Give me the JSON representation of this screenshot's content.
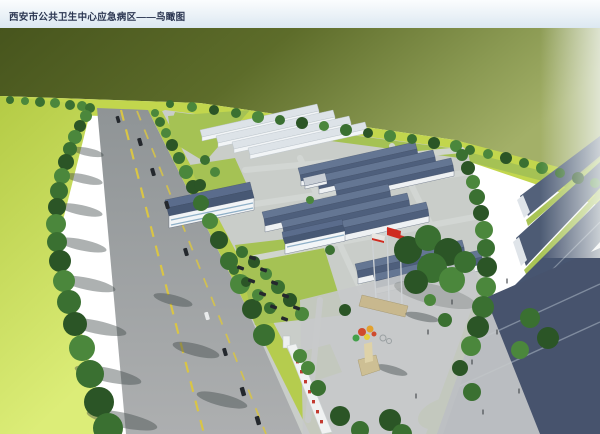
{
  "header": {
    "title": "西安市公共卫生中心应急病区——鸟瞰图"
  },
  "colors": {
    "title_text": "#2a3550",
    "titlebar_top": "#fbfdfe",
    "titlebar_bottom": "#dce8f1",
    "field_dark": "#47551d",
    "field_light": "#a3b068",
    "grass_bright": "#c2d64d",
    "grass_pale": "#dced78",
    "tree_dark": "#2b5526",
    "tree_light": "#5d9a49",
    "road_surface": "#9a9ea0",
    "road_marking": "#d9c545",
    "campus_paving": "#c9cdc9",
    "lawn_green": "#a5c254",
    "roof_slate_light": "#647693",
    "roof_slate_dark": "#4e5f7c",
    "roof_white_building": "#dde3e8",
    "wall_white": "#f2f5f7",
    "warehouse_roof": "#47536d",
    "flag_red": "#cf2b20",
    "flag_base_tan": "#c8b88e",
    "gate_sign_red": "#c23a30",
    "car_dark": "#24282d",
    "shadow_gray": "#3c4644",
    "haze_white": "#f4f7f5"
  },
  "scene": {
    "kind": "aerial-architectural-rendering",
    "objects": [
      "field",
      "grass-plain",
      "main-road",
      "road-centerline",
      "roadside-tree-row",
      "campus-grounds",
      "white-service-buildings",
      "ward-buildings",
      "admin-building",
      "perimeter-tree-belt",
      "entrance-plaza",
      "flagpoles",
      "red-flags",
      "entrance-sculpture",
      "gate-wall",
      "gate-sign-characters",
      "parked-cars",
      "road-cars",
      "warehouse-roofs",
      "pedestrians"
    ]
  }
}
